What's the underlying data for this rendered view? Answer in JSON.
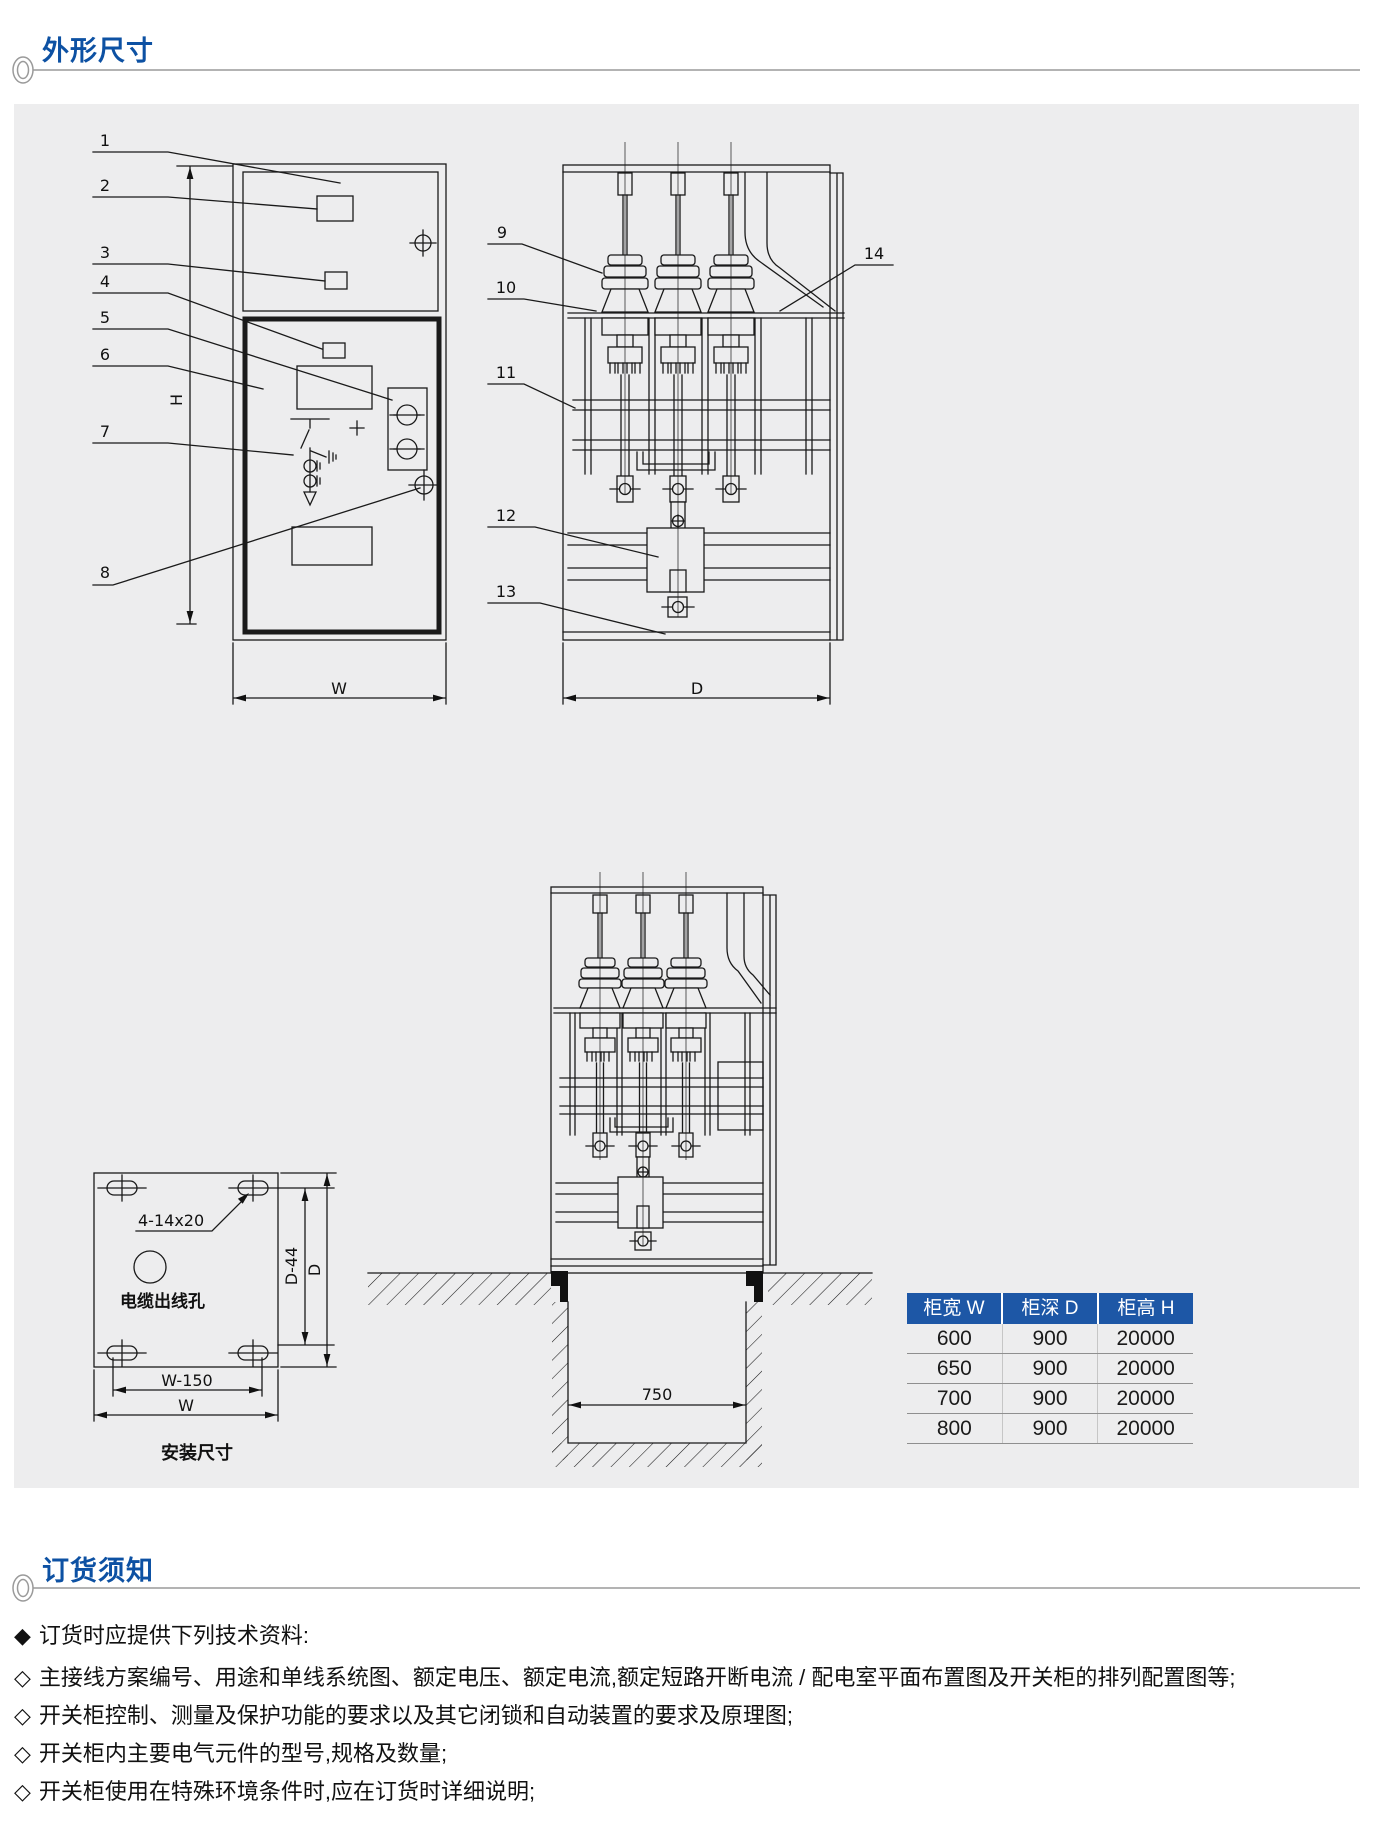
{
  "page_titles": {
    "outline": "外形尺寸",
    "ordering": "订货须知"
  },
  "front_view": {
    "part_numbers": [
      "1",
      "2",
      "3",
      "4",
      "5",
      "6",
      "7",
      "8"
    ],
    "dim_height": "H",
    "dim_width": "W"
  },
  "side_view": {
    "part_numbers": [
      "9",
      "10",
      "11",
      "12",
      "13",
      "14"
    ],
    "dim_depth": "D"
  },
  "foundation_view": {
    "trench_width": "750"
  },
  "installation_view": {
    "slot_label": "4-14x20",
    "hole_label": "电缆出线孔",
    "dim_hole_pitch_depth": "D-44",
    "dim_depth": "D",
    "dim_hole_pitch_width": "W-150",
    "dim_width": "W",
    "caption": "安装尺寸"
  },
  "dimensions_table": {
    "headers": [
      "柜宽 W",
      "柜深 D",
      "柜高 H"
    ],
    "rows": [
      [
        "600",
        "900",
        "20000"
      ],
      [
        "650",
        "900",
        "20000"
      ],
      [
        "700",
        "900",
        "20000"
      ],
      [
        "800",
        "900",
        "20000"
      ]
    ]
  },
  "ordering_notes": {
    "intro_marker": "◆",
    "intro": "订货时应提供下列技术资料:",
    "item_marker": "◇",
    "items": [
      "主接线方案编号、用途和单线系统图、额定电压、额定电流,额定短路开断电流 / 配电室平面布置图及开关柜的排列配置图等;",
      "开关柜控制、测量及保护功能的要求以及其它闭锁和自动装置的要求及原理图;",
      "开关柜内主要电气元件的型号,规格及数量;",
      "开关柜使用在特殊环境条件时,应在订货时详细说明;"
    ]
  },
  "colors": {
    "accent_blue": "#0d51a3",
    "table_header_blue": "#1d57a6",
    "panel_gray": "#ededee",
    "line_color": "#1a1a1a"
  }
}
